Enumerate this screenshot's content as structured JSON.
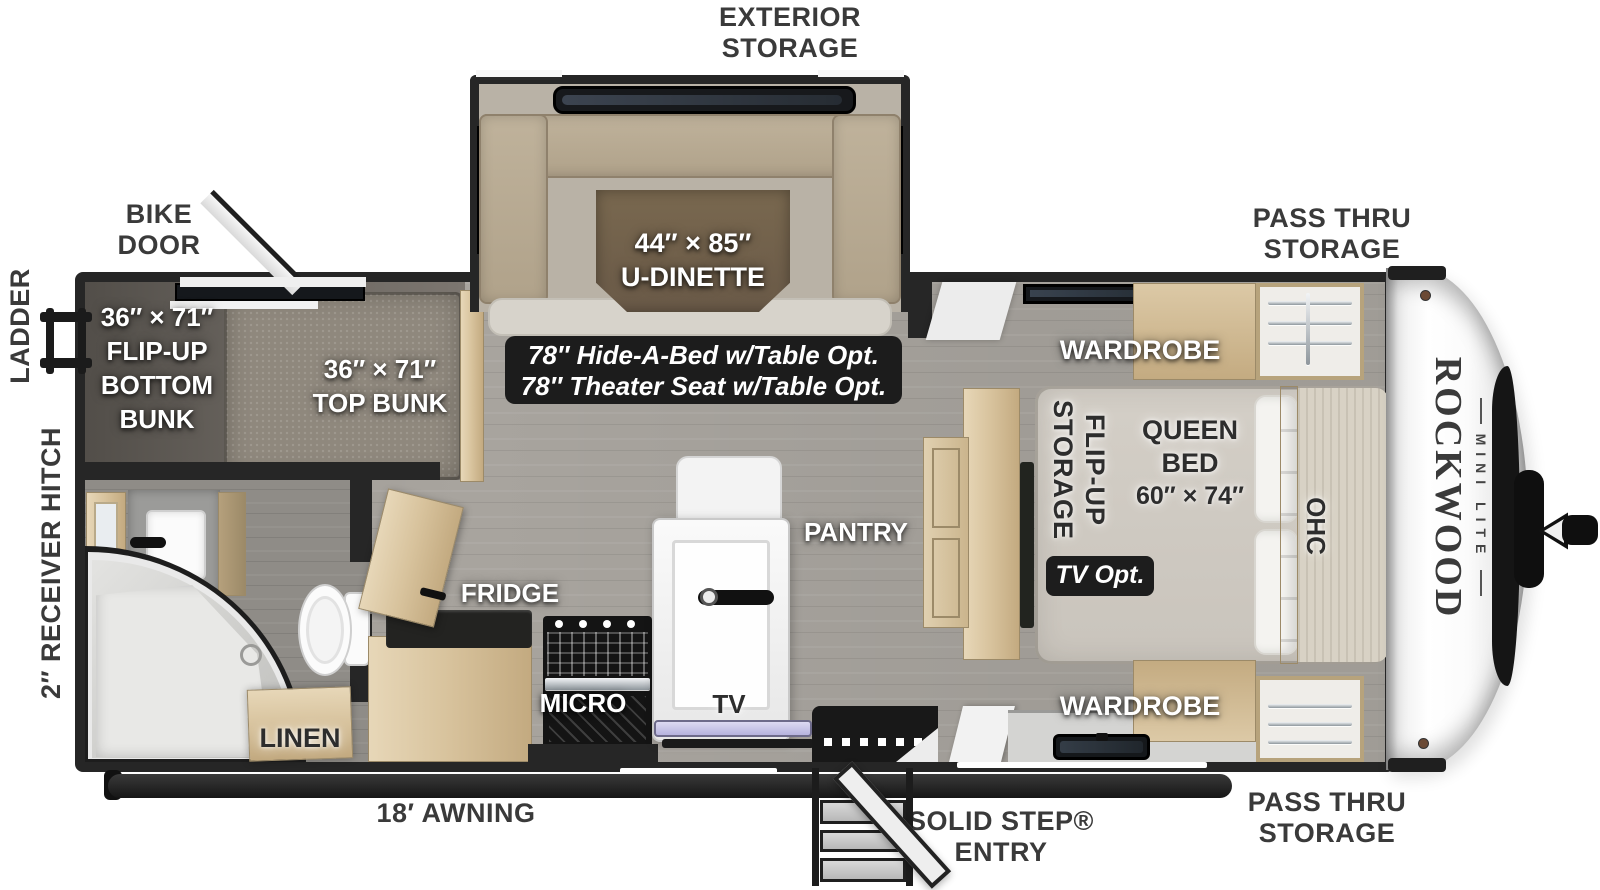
{
  "palette": {
    "wall": "#262626",
    "floor": "#a8a49e",
    "wood": "#d8c39d",
    "note_bg": "#1c1c1c",
    "cap_white": "#f7f7f7",
    "tv_accent": "#c7c3e8"
  },
  "exterior": {
    "exterior_storage": [
      "EXTERIOR",
      "STORAGE"
    ],
    "bike_door": [
      "BIKE",
      "DOOR"
    ],
    "ladder": "LADDER",
    "receiver_hitch": "2″ RECEIVER HITCH",
    "pass_thru_top": [
      "PASS THRU",
      "STORAGE"
    ],
    "pass_thru_bottom": [
      "PASS THRU",
      "STORAGE"
    ],
    "awning": "18′ AWNING",
    "solid_step": [
      "SOLID STEP®",
      "ENTRY"
    ]
  },
  "bunkroom": {
    "bottom_bunk": [
      "36″ × 71″",
      "FLIP-UP",
      "BOTTOM",
      "BUNK"
    ],
    "top_bunk": [
      "36″ × 71″",
      "TOP BUNK"
    ]
  },
  "bath": {
    "linen": "LINEN"
  },
  "dinette": {
    "size": "44″ × 85″",
    "name": "U-DINETTE",
    "options": [
      "78″ Hide-A-Bed w/Table Opt.",
      "78″ Theater Seat w/Table Opt."
    ]
  },
  "kitchen": {
    "fridge": "FRIDGE",
    "micro": "MICRO",
    "tv": "TV",
    "pantry": "PANTRY"
  },
  "bedroom": {
    "wardrobe_top": "WARDROBE",
    "wardrobe_bottom": "WARDROBE",
    "flip_up_storage": [
      "FLIP-UP",
      "STORAGE"
    ],
    "queen_bed": [
      "QUEEN",
      "BED",
      "60″ × 74″"
    ],
    "ohc": "OHC",
    "tv_opt": "TV Opt."
  },
  "brand": {
    "name": "ROCKWOOD",
    "series": "MINI LITE"
  }
}
